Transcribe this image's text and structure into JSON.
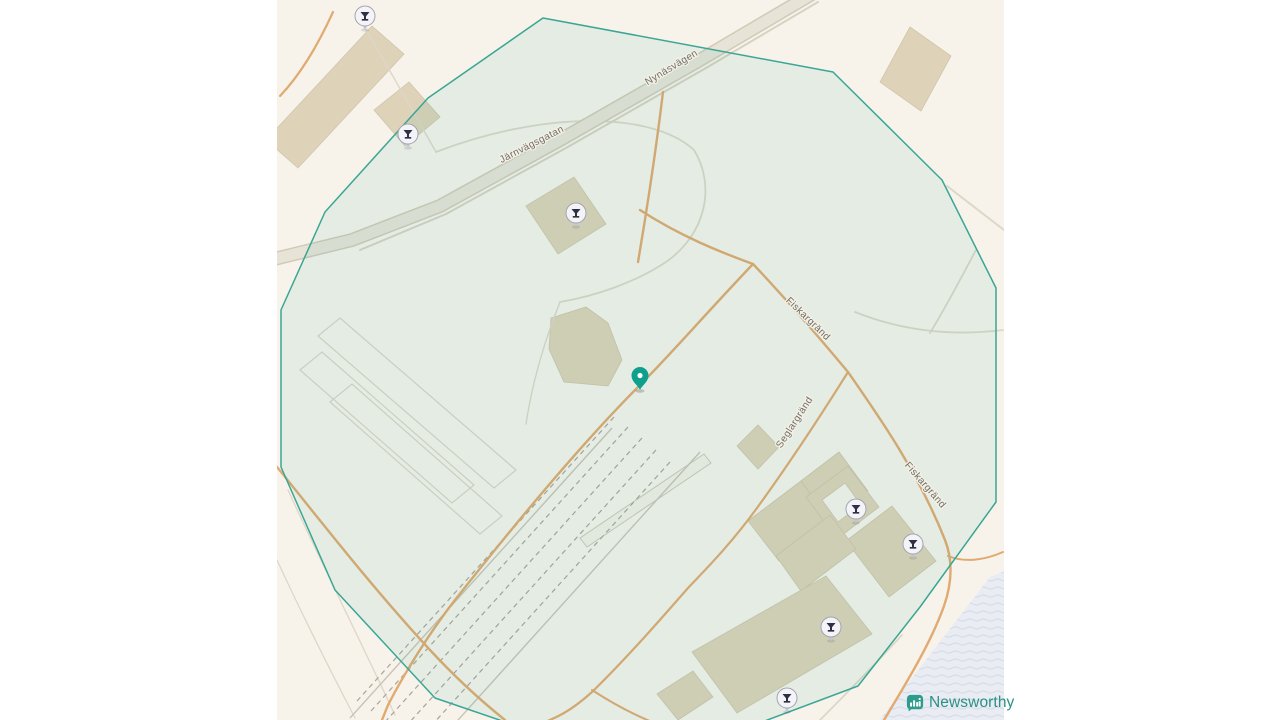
{
  "map": {
    "base_color": "#f7f3eb",
    "street_labels": [
      {
        "text": "Nynäsvägen",
        "x": 673,
        "y": 70,
        "rot": -31
      },
      {
        "text": "Järnvägsgatan",
        "x": 533,
        "y": 147,
        "rot": -27
      },
      {
        "text": "Fiskargränd",
        "x": 806,
        "y": 321,
        "rot": 44
      },
      {
        "text": "Seglargränd",
        "x": 797,
        "y": 424,
        "rot": -57
      },
      {
        "text": "Fiskargränd",
        "x": 923,
        "y": 487,
        "rot": 49
      }
    ],
    "highlight_polygon": {
      "points": "543,18 833,72 942,180 996,288 996,502 920,607 858,686 762,722 640,736 520,727 435,698 335,590 281,467 281,310 325,212 428,98",
      "stroke": "#3aa695",
      "fill": "rgba(26,156,138,0.08)"
    },
    "main_marker": {
      "x": 640,
      "y": 390,
      "color": "#0fa08d"
    },
    "poi_pins": [
      {
        "x": 365,
        "y": 16
      },
      {
        "x": 408,
        "y": 134
      },
      {
        "x": 576,
        "y": 213
      },
      {
        "x": 856,
        "y": 509
      },
      {
        "x": 913,
        "y": 544
      },
      {
        "x": 831,
        "y": 627
      },
      {
        "x": 787,
        "y": 698
      }
    ],
    "poi_pin_colors": {
      "bulb": "#f4f3f8",
      "stroke": "#a3a2b2",
      "glyph": "#2f2f45",
      "tail": "#c6c5d2"
    }
  },
  "attribution": {
    "brand": "Newsworthy",
    "brand_color": "#2a9184",
    "logo_color": "#2e9c8d"
  }
}
